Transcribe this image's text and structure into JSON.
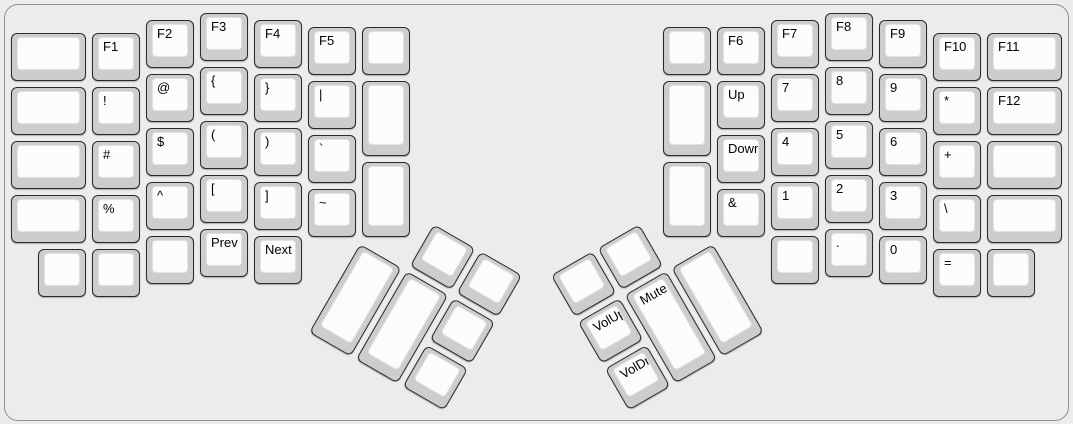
{
  "app": {
    "name": "keyboard-layout",
    "description": "ErgoDox split keyboard layout, function/symbol/media layer"
  },
  "keyboard": {
    "unit_px": 54,
    "key_inset_px": 3,
    "colors": {
      "page_bg": "#ececec",
      "case_border": "#8f8f8f",
      "keycap_side": "#cdcdcd",
      "keycap_border": "#2a2a2a",
      "keycap_top": "#fcfcfc",
      "keycap_top_border": "#e2e2e2",
      "label": "#000000"
    },
    "halves": [
      {
        "name": "left-half",
        "origin_x": 8,
        "origin_y": 10,
        "rotation": 0,
        "keys": [
          [
            0,
            0.375,
            1.5,
            1,
            "",
            "key-blank-l01"
          ],
          [
            0,
            1.375,
            1.5,
            1,
            "",
            "key-blank-l02"
          ],
          [
            0,
            2.375,
            1.5,
            1,
            "",
            "key-blank-l03"
          ],
          [
            0,
            3.375,
            1.5,
            1,
            "",
            "key-blank-l04"
          ],
          [
            1.5,
            0.375,
            1,
            1,
            "F1",
            "key-f1"
          ],
          [
            1.5,
            1.375,
            1,
            1,
            "!",
            "key-exclamation"
          ],
          [
            1.5,
            2.375,
            1,
            1,
            "#",
            "key-hash"
          ],
          [
            1.5,
            3.375,
            1,
            1,
            "%",
            "key-percent"
          ],
          [
            0.5,
            4.375,
            1,
            1,
            "",
            "key-blank-l05"
          ],
          [
            1.5,
            4.375,
            1,
            1,
            "",
            "key-blank-l06"
          ],
          [
            2.5,
            0.125,
            1,
            1,
            "F2",
            "key-f2"
          ],
          [
            2.5,
            1.125,
            1,
            1,
            "@",
            "key-at"
          ],
          [
            2.5,
            2.125,
            1,
            1,
            "$",
            "key-dollar"
          ],
          [
            2.5,
            3.125,
            1,
            1,
            "^",
            "key-caret"
          ],
          [
            2.5,
            4.125,
            1,
            1,
            "",
            "key-blank-l07"
          ],
          [
            3.5,
            0,
            1,
            1,
            "F3",
            "key-f3"
          ],
          [
            3.5,
            1,
            1,
            1,
            "{",
            "key-open-brace"
          ],
          [
            3.5,
            2,
            1,
            1,
            "(",
            "key-open-paren"
          ],
          [
            3.5,
            3,
            1,
            1,
            "[",
            "key-open-bracket"
          ],
          [
            3.5,
            4,
            1,
            1,
            "Prev",
            "key-prev-track"
          ],
          [
            4.5,
            0.125,
            1,
            1,
            "F4",
            "key-f4"
          ],
          [
            4.5,
            1.125,
            1,
            1,
            "}",
            "key-close-brace"
          ],
          [
            4.5,
            2.125,
            1,
            1,
            ")",
            "key-close-paren"
          ],
          [
            4.5,
            3.125,
            1,
            1,
            "]",
            "key-close-bracket"
          ],
          [
            4.5,
            4.125,
            1,
            1,
            "Next",
            "key-next-track"
          ],
          [
            5.5,
            0.25,
            1,
            1,
            "F5",
            "key-f5"
          ],
          [
            5.5,
            1.25,
            1,
            1,
            "|",
            "key-pipe"
          ],
          [
            5.5,
            2.25,
            1,
            1,
            "`",
            "key-backtick"
          ],
          [
            5.5,
            3.25,
            1,
            1,
            "~",
            "key-tilde"
          ],
          [
            6.5,
            0.25,
            1,
            1,
            "",
            "key-blank-l08"
          ],
          [
            6.5,
            1.25,
            1,
            1.5,
            "",
            "key-blank-l09"
          ],
          [
            6.5,
            2.75,
            1,
            1.5,
            "",
            "key-blank-l10"
          ]
        ]
      },
      {
        "name": "right-half",
        "origin_x": 660,
        "origin_y": 10,
        "rotation": 0,
        "keys": [
          [
            0,
            0.25,
            1,
            1,
            "",
            "key-blank-r01"
          ],
          [
            0,
            1.25,
            1,
            1.5,
            "",
            "key-blank-r02"
          ],
          [
            0,
            2.75,
            1,
            1.5,
            "",
            "key-blank-r03"
          ],
          [
            1,
            0.25,
            1,
            1,
            "F6",
            "key-f6"
          ],
          [
            1,
            1.25,
            1,
            1,
            "Up",
            "key-up"
          ],
          [
            1,
            2.25,
            1,
            1,
            "Down",
            "key-down"
          ],
          [
            1,
            3.25,
            1,
            1,
            "&",
            "key-ampersand"
          ],
          [
            2,
            0.125,
            1,
            1,
            "F7",
            "key-f7"
          ],
          [
            2,
            1.125,
            1,
            1,
            "7",
            "key-7"
          ],
          [
            2,
            2.125,
            1,
            1,
            "4",
            "key-4"
          ],
          [
            2,
            3.125,
            1,
            1,
            "1",
            "key-1"
          ],
          [
            2,
            4.125,
            1,
            1,
            "",
            "key-blank-r04"
          ],
          [
            3,
            0,
            1,
            1,
            "F8",
            "key-f8"
          ],
          [
            3,
            1,
            1,
            1,
            "8",
            "key-8"
          ],
          [
            3,
            2,
            1,
            1,
            "5",
            "key-5"
          ],
          [
            3,
            3,
            1,
            1,
            "2",
            "key-2"
          ],
          [
            3,
            4,
            1,
            1,
            ".",
            "key-period"
          ],
          [
            4,
            0.125,
            1,
            1,
            "F9",
            "key-f9"
          ],
          [
            4,
            1.125,
            1,
            1,
            "9",
            "key-9"
          ],
          [
            4,
            2.125,
            1,
            1,
            "6",
            "key-6"
          ],
          [
            4,
            3.125,
            1,
            1,
            "3",
            "key-3"
          ],
          [
            4,
            4.125,
            1,
            1,
            "0",
            "key-0"
          ],
          [
            5,
            0.375,
            1,
            1,
            "F10",
            "key-f10"
          ],
          [
            5,
            1.375,
            1,
            1,
            "*",
            "key-asterisk"
          ],
          [
            5,
            2.375,
            1,
            1,
            "+",
            "key-plus"
          ],
          [
            5,
            3.375,
            1,
            1,
            "\\",
            "key-backslash"
          ],
          [
            5,
            4.375,
            1,
            1,
            "=",
            "key-equals"
          ],
          [
            6,
            0.375,
            1.5,
            1,
            "F11",
            "key-f11"
          ],
          [
            6,
            1.375,
            1.5,
            1,
            "F12",
            "key-f12"
          ],
          [
            6,
            2.375,
            1.5,
            1,
            "",
            "key-blank-r05"
          ],
          [
            6,
            3.375,
            1.5,
            1,
            "",
            "key-blank-r06"
          ],
          [
            6,
            4.375,
            1,
            1,
            "",
            "key-blank-r07"
          ]
        ]
      },
      {
        "name": "left-thumb-cluster",
        "origin_x": 359,
        "origin_y": 239.5,
        "rotation": 30,
        "keys": [
          [
            1,
            -1,
            1,
            1,
            "",
            "key-blank-lt1"
          ],
          [
            2,
            -1,
            1,
            1,
            "",
            "key-blank-lt2"
          ],
          [
            0,
            0,
            1,
            2,
            "",
            "key-blank-lt3"
          ],
          [
            1,
            0,
            1,
            2,
            "",
            "key-blank-lt4"
          ],
          [
            2,
            0,
            1,
            1,
            "",
            "key-blank-lt5"
          ],
          [
            2,
            1,
            1,
            1,
            "",
            "key-blank-lt6"
          ]
        ]
      },
      {
        "name": "right-thumb-cluster",
        "origin_x": 714,
        "origin_y": 239.5,
        "rotation": -30,
        "keys": [
          [
            -3,
            -1,
            1,
            1,
            "",
            "key-blank-rt1"
          ],
          [
            -2,
            -1,
            1,
            1,
            "",
            "key-blank-rt2"
          ],
          [
            -3,
            0,
            1,
            1,
            "VolUp",
            "key-volume-up"
          ],
          [
            -3,
            1,
            1,
            1,
            "VolDn",
            "key-volume-down"
          ],
          [
            -2,
            0,
            1,
            2,
            "Mute",
            "key-mute"
          ],
          [
            -1,
            0,
            1,
            2,
            "",
            "key-blank-rt3"
          ]
        ]
      }
    ]
  }
}
